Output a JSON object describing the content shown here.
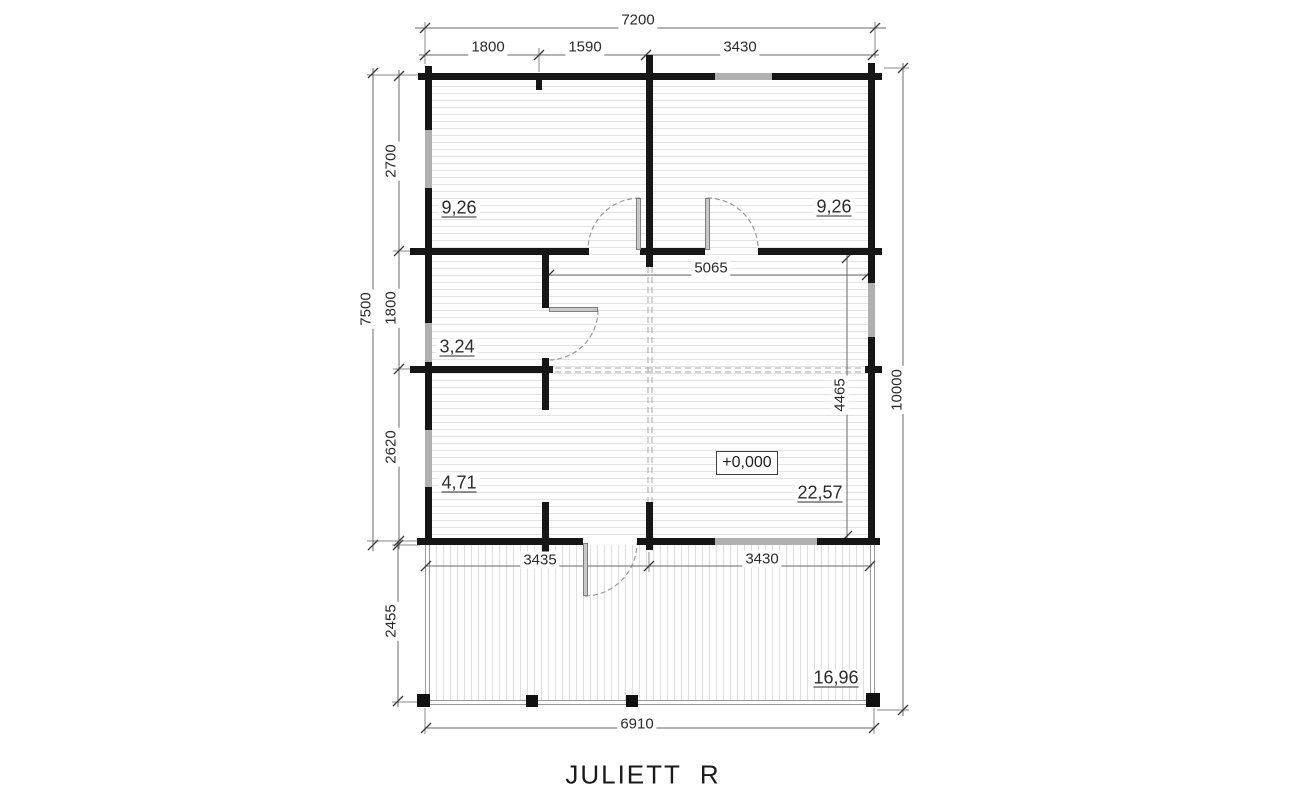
{
  "title": "JULIETT  R",
  "elevation": "+0,000",
  "dims": {
    "top_overall": "7200",
    "top_a": "1800",
    "top_b": "1590",
    "top_c": "3430",
    "left_overall": "7500",
    "left_a": "2700",
    "left_b": "1800",
    "left_c": "2620",
    "terrace_depth": "2455",
    "right_overall": "10000",
    "living_depth": "4465",
    "hall_width": "5065",
    "terrace_a": "3435",
    "terrace_b": "3430",
    "terrace_overall": "6910"
  },
  "rooms": {
    "bedroom_left": "9,26",
    "bedroom_right": "9,26",
    "bathroom": "3,24",
    "storage": "4,71",
    "living": "22,57",
    "terrace": "16,96"
  },
  "colors": {
    "wall": "#161616",
    "window_marker": "#b0b0b0",
    "floor_hatch": "#e4e4e4",
    "dimension_line": "#6a6a6a"
  }
}
